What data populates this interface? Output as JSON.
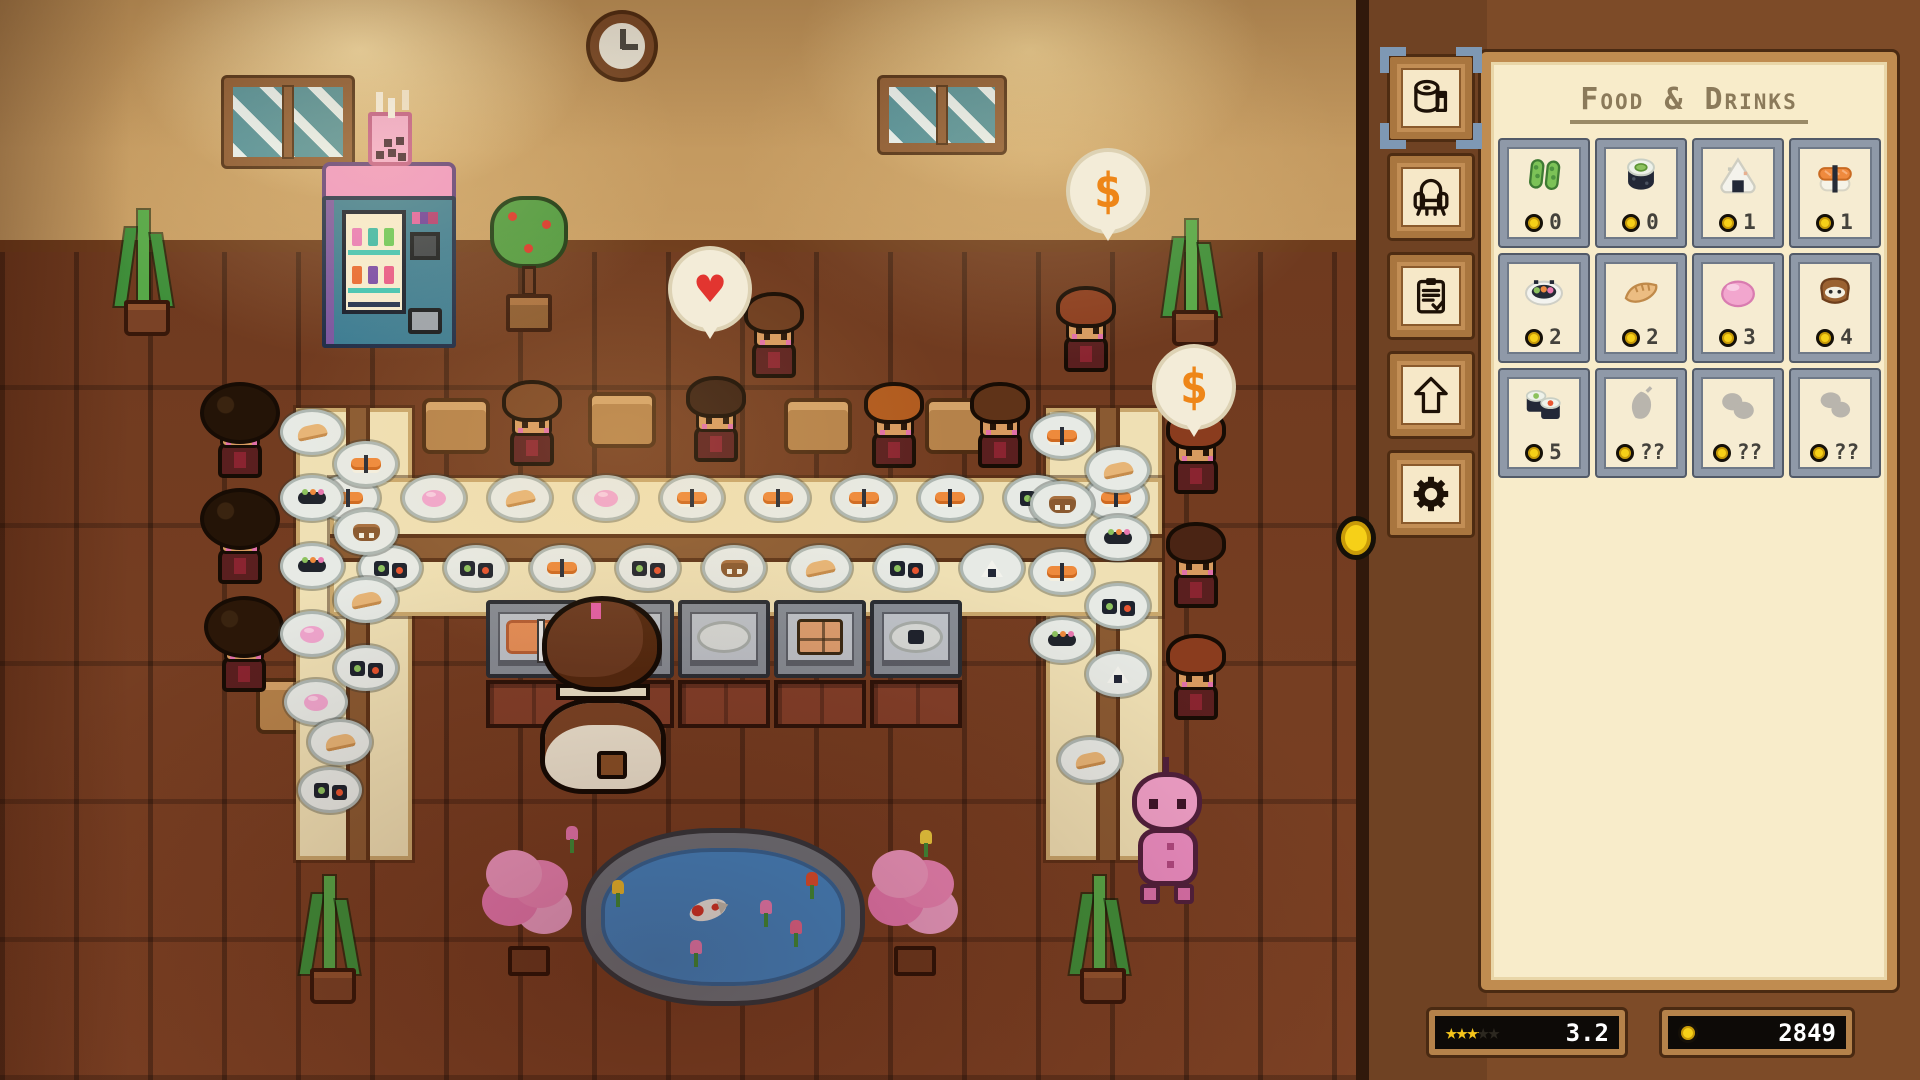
{
  "panel": {
    "title": "Food & Drinks",
    "tabs": [
      {
        "id": "food-drinks",
        "icon": "paper-roll-icon",
        "selected": true
      },
      {
        "id": "furniture",
        "icon": "armchair-icon",
        "selected": false
      },
      {
        "id": "tasks",
        "icon": "clipboard-icon",
        "selected": false
      },
      {
        "id": "upgrades",
        "icon": "up-arrow-icon",
        "selected": false
      },
      {
        "id": "settings",
        "icon": "gear-icon",
        "selected": false
      }
    ],
    "items": [
      {
        "name": "edamame",
        "price": "0",
        "locked": false
      },
      {
        "name": "maki-roll",
        "price": "0",
        "locked": false
      },
      {
        "name": "onigiri",
        "price": "1",
        "locked": false
      },
      {
        "name": "salmon-nigiri",
        "price": "1",
        "locked": false
      },
      {
        "name": "sushi-platter",
        "price": "2",
        "locked": false
      },
      {
        "name": "gyoza",
        "price": "2",
        "locked": false
      },
      {
        "name": "mochi",
        "price": "3",
        "locked": false
      },
      {
        "name": "inari",
        "price": "4",
        "locked": false
      },
      {
        "name": "maki-set",
        "price": "5",
        "locked": false
      },
      {
        "name": "locked-item",
        "price": "??",
        "locked": true
      },
      {
        "name": "locked-item",
        "price": "??",
        "locked": true
      },
      {
        "name": "locked-item",
        "price": "??",
        "locked": true
      }
    ],
    "rating": {
      "value": "3.2",
      "max_stars": 5,
      "stars_glyph": "★★★★★"
    },
    "money": "2849"
  },
  "scene": {
    "bubbles": [
      {
        "type": "heart",
        "glyph": "♥"
      },
      {
        "type": "dollar",
        "glyph": "$"
      },
      {
        "type": "dollar",
        "glyph": "$"
      }
    ],
    "plates": [
      {
        "x": 348,
        "y": 498,
        "food": "nigiri"
      },
      {
        "x": 434,
        "y": 498,
        "food": "mochi"
      },
      {
        "x": 520,
        "y": 498,
        "food": "gyoza"
      },
      {
        "x": 606,
        "y": 498,
        "food": "mochi"
      },
      {
        "x": 692,
        "y": 498,
        "food": "nigiri"
      },
      {
        "x": 778,
        "y": 498,
        "food": "nigiri"
      },
      {
        "x": 864,
        "y": 498,
        "food": "nigiri"
      },
      {
        "x": 950,
        "y": 498,
        "food": "nigiri"
      },
      {
        "x": 1036,
        "y": 498,
        "food": "maki"
      },
      {
        "x": 1116,
        "y": 498,
        "food": "nigiri"
      },
      {
        "x": 390,
        "y": 568,
        "food": "maki"
      },
      {
        "x": 476,
        "y": 568,
        "food": "maki"
      },
      {
        "x": 562,
        "y": 568,
        "food": "nigiri"
      },
      {
        "x": 648,
        "y": 568,
        "food": "maki"
      },
      {
        "x": 734,
        "y": 568,
        "food": "inari"
      },
      {
        "x": 820,
        "y": 568,
        "food": "gyoza"
      },
      {
        "x": 906,
        "y": 568,
        "food": "maki"
      },
      {
        "x": 992,
        "y": 568,
        "food": "onigiri"
      },
      {
        "x": 312,
        "y": 432,
        "food": "gyoza"
      },
      {
        "x": 366,
        "y": 464,
        "food": "nigiri"
      },
      {
        "x": 312,
        "y": 498,
        "food": "sushi"
      },
      {
        "x": 366,
        "y": 532,
        "food": "inari"
      },
      {
        "x": 312,
        "y": 566,
        "food": "sushi"
      },
      {
        "x": 366,
        "y": 600,
        "food": "gyoza"
      },
      {
        "x": 312,
        "y": 634,
        "food": "mochi"
      },
      {
        "x": 366,
        "y": 668,
        "food": "maki"
      },
      {
        "x": 316,
        "y": 702,
        "food": "mochi"
      },
      {
        "x": 340,
        "y": 742,
        "food": "gyoza"
      },
      {
        "x": 330,
        "y": 790,
        "food": "maki"
      },
      {
        "x": 1062,
        "y": 436,
        "food": "nigiri"
      },
      {
        "x": 1118,
        "y": 470,
        "food": "gyoza"
      },
      {
        "x": 1062,
        "y": 504,
        "food": "inari"
      },
      {
        "x": 1118,
        "y": 538,
        "food": "sushi"
      },
      {
        "x": 1062,
        "y": 572,
        "food": "nigiri"
      },
      {
        "x": 1118,
        "y": 606,
        "food": "maki"
      },
      {
        "x": 1062,
        "y": 640,
        "food": "sushi"
      },
      {
        "x": 1118,
        "y": 674,
        "food": "onigiri"
      },
      {
        "x": 1090,
        "y": 760,
        "food": "gyoza"
      }
    ],
    "customers": [
      {
        "x": 742,
        "y": 292,
        "hair": "#6b3a1e",
        "style": ""
      },
      {
        "x": 1054,
        "y": 286,
        "hair": "#8a3c1e",
        "style": ""
      },
      {
        "x": 500,
        "y": 380,
        "hair": "#7a4524",
        "style": ""
      },
      {
        "x": 684,
        "y": 376,
        "hair": "#3a2012",
        "style": ""
      },
      {
        "x": 862,
        "y": 382,
        "hair": "#b05a1e",
        "style": ""
      },
      {
        "x": 968,
        "y": 382,
        "hair": "#5f3318",
        "style": ""
      },
      {
        "x": 208,
        "y": 392,
        "hair": "#241407",
        "style": "afro"
      },
      {
        "x": 208,
        "y": 498,
        "hair": "#241407",
        "style": "afro"
      },
      {
        "x": 212,
        "y": 606,
        "hair": "#2b1708",
        "style": "afro"
      },
      {
        "x": 1164,
        "y": 408,
        "hair": "#8a3c1e",
        "style": ""
      },
      {
        "x": 1164,
        "y": 522,
        "hair": "#4a2414",
        "style": ""
      },
      {
        "x": 1164,
        "y": 634,
        "hair": "#8a3c1e",
        "style": ""
      }
    ]
  }
}
